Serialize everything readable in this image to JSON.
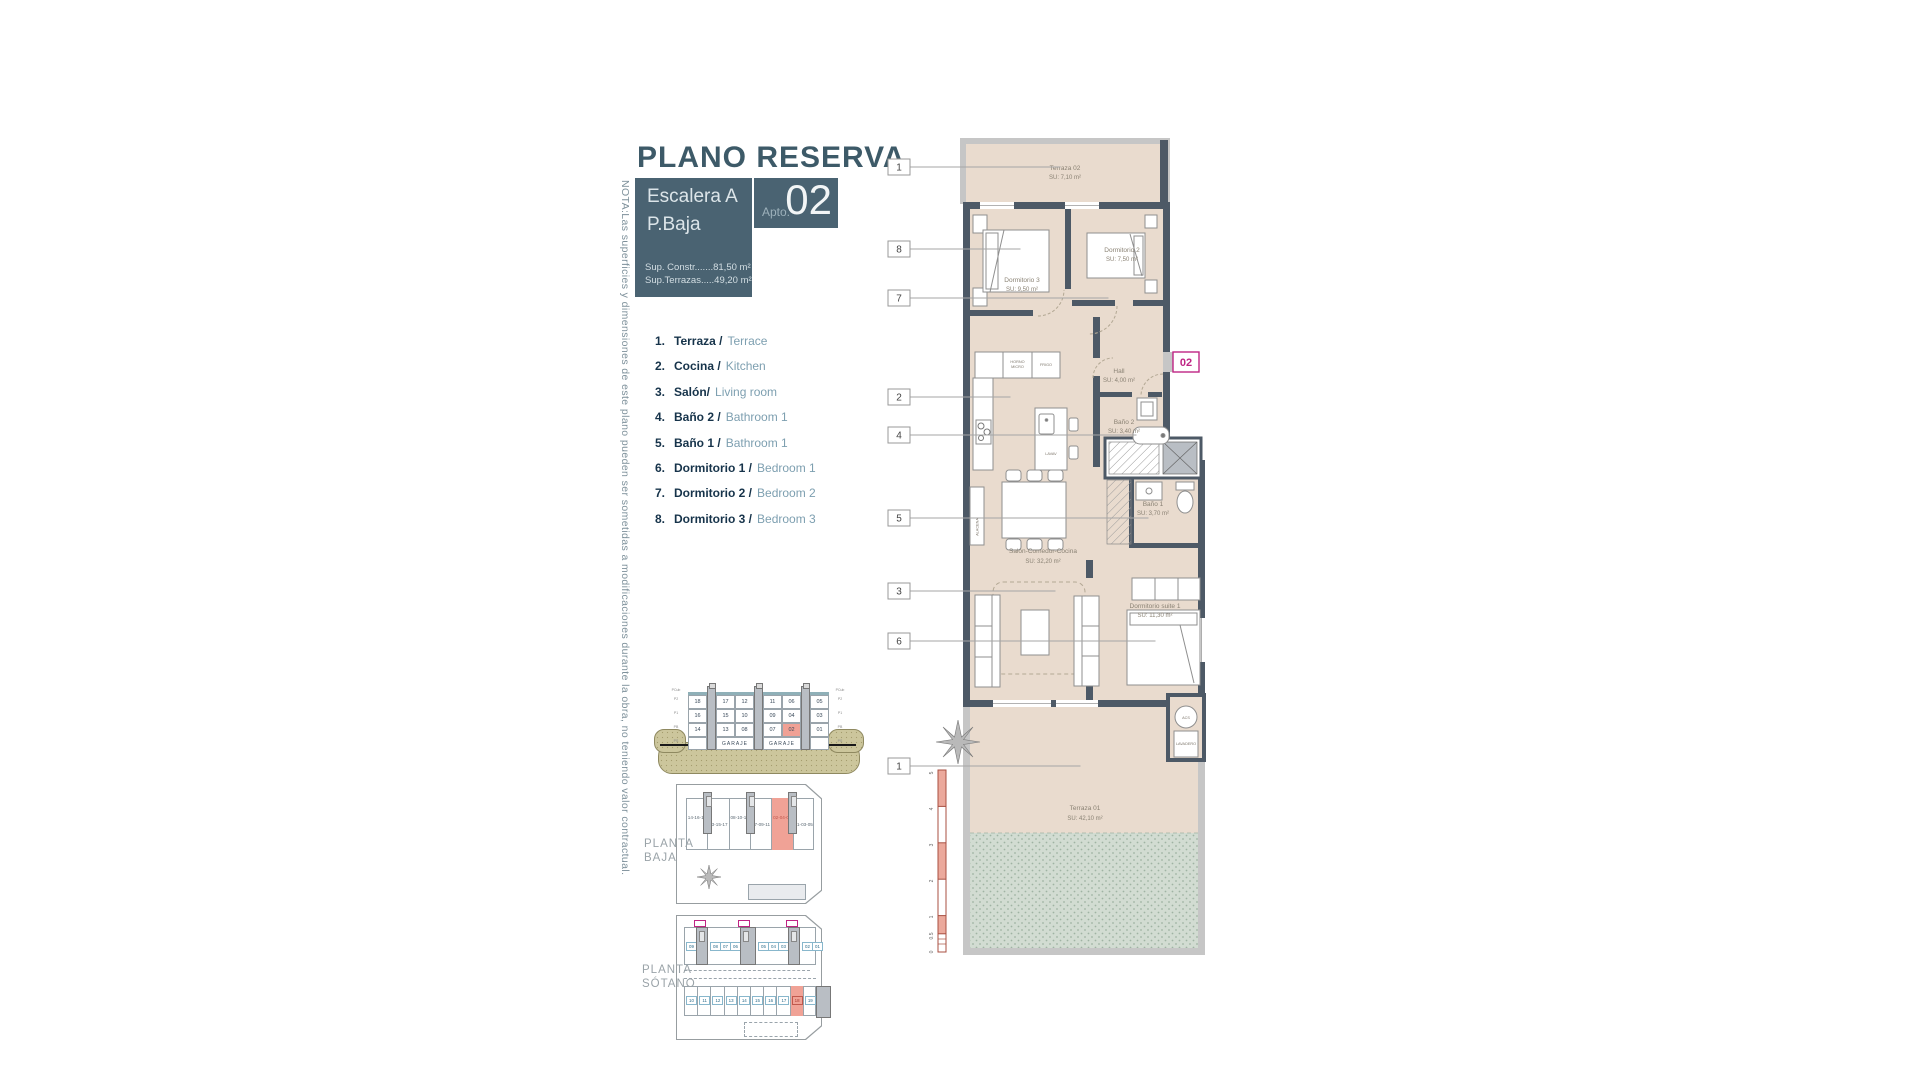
{
  "note_vertical": "NOTA:Las superficies y dimensiones de este plano pueden ser sometidas a modificaciones durante la obra, no teniendo valor contractual.",
  "header": {
    "title": "PLANO RESERVA",
    "block": {
      "line1": "Escalera A",
      "line2": "P.Baja",
      "sup1": "Sup. Constr.......81,50 m²",
      "sup2": "Sup.Terrazas.....49,20 m²"
    },
    "apto": {
      "prefix": "Apto.",
      "number": "02"
    }
  },
  "legend": {
    "items": [
      {
        "num": "1.",
        "es": "Terraza /",
        "en": "Terrace"
      },
      {
        "num": "2.",
        "es": "Cocina /",
        "en": "Kitchen"
      },
      {
        "num": "3.",
        "es": "Salón/",
        "en": "Living room"
      },
      {
        "num": "4.",
        "es": "Baño 2 /",
        "en": "Bathroom 1"
      },
      {
        "num": "5.",
        "es": "Baño 1 /",
        "en": "Bathroom 1"
      },
      {
        "num": "6.",
        "es": "Dormitorio 1 /",
        "en": "Bedroom 1"
      },
      {
        "num": "7.",
        "es": "Dormitorio 2 /",
        "en": "Bedroom 2"
      },
      {
        "num": "8.",
        "es": "Dormitorio 3 /",
        "en": "Bedroom 3"
      }
    ]
  },
  "plan": {
    "badge": "02",
    "callouts": [
      "1",
      "8",
      "7",
      "2",
      "4",
      "5",
      "3",
      "6",
      "1"
    ],
    "rooms": {
      "terraza02": {
        "name": "Terraza 02",
        "area": "SU: 7,10 m²"
      },
      "dorm3": {
        "name": "Dormitorio 3",
        "area": "SU: 9,50 m²"
      },
      "dorm2": {
        "name": "Dormitorio 2",
        "area": "SU: 7,50 m²"
      },
      "hall": {
        "name": "Hall",
        "area": "SU: 4,00 m²"
      },
      "bano2": {
        "name": "Baño 2",
        "area": "SU: 3,40 m²"
      },
      "bano1": {
        "name": "Baño 1",
        "area": "SU: 3,70 m²"
      },
      "salon": {
        "name": "Salón-Comedor-Cocina",
        "area": "SU: 32,20 m²"
      },
      "suite": {
        "name": "Dormitorio suite 1",
        "area": "SU: 11,30 m²"
      },
      "terraza01": {
        "name": "Terraza 01",
        "area": "SU: 42,10 m²"
      }
    },
    "kitchen": {
      "horno1": "HORNO",
      "horno2": "MICRO",
      "frigo": "FRIGO",
      "lavav": "LAVAV",
      "alacena": "ALACENA"
    },
    "acs": "ACS",
    "lavadero": "LAVADERO",
    "scale_ticks": [
      "5",
      "4",
      "3",
      "2",
      "1",
      "0.5",
      "0"
    ]
  },
  "section": {
    "rows": [
      [
        "18",
        "17",
        "12",
        "11",
        "06",
        "05"
      ],
      [
        "16",
        "15",
        "10",
        "09",
        "04",
        "03"
      ],
      [
        "14",
        "13",
        "08",
        "07",
        "02",
        "01"
      ]
    ],
    "highlight": "02",
    "garaje": "GARAJE",
    "floor_labels": [
      "PCub",
      "P2",
      "P1",
      "PB",
      "PS"
    ]
  },
  "planta_baja": {
    "label1": "PLANTA",
    "label2": "BAJA",
    "units": [
      "14-16-18",
      "13-15-17",
      "08-10-12",
      "07-09-11",
      "02-04-06",
      "01-03-05"
    ],
    "highlight": "02-04-06"
  },
  "planta_sotano": {
    "label1": "PLANTA",
    "label2": "SÓTANO",
    "trasteros": [
      "09",
      "08",
      "07",
      "06",
      "05",
      "04",
      "03",
      "02",
      "01"
    ],
    "parking": [
      "10",
      "11",
      "12",
      "13",
      "14",
      "15",
      "16",
      "17",
      "18",
      "19"
    ],
    "highlight": "18"
  },
  "colors": {
    "accent_slate": "#4a6372",
    "wall": "#4d5966",
    "room_fill": "#e9dbce",
    "highlight_pink": "#f0a296",
    "magenta": "#bf2484",
    "legend_dark": "#16334a",
    "legend_light": "#7d9fb0"
  }
}
